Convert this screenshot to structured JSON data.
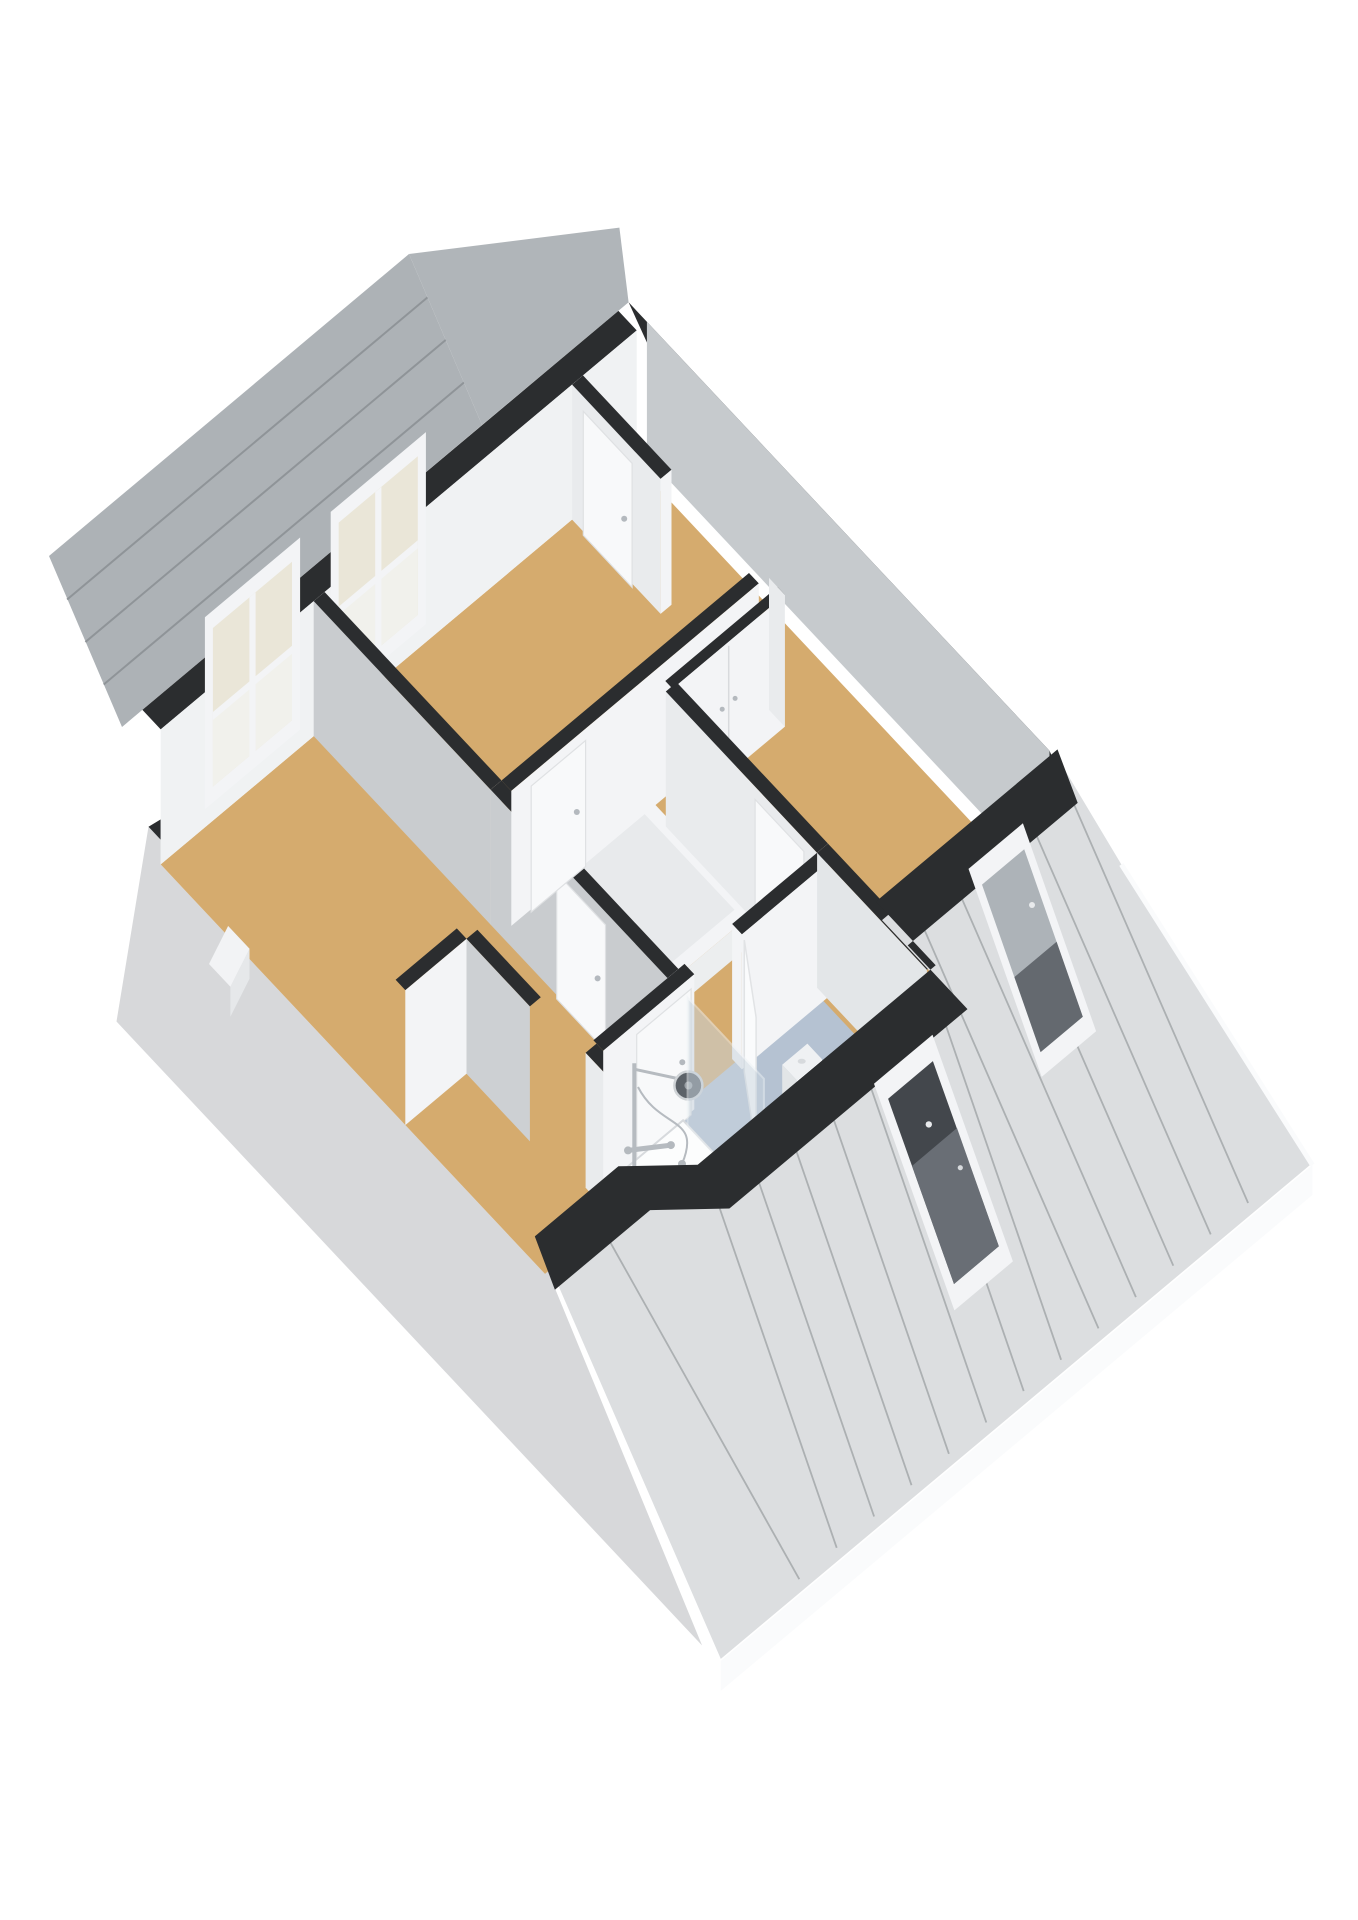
{
  "view": {
    "type": "3d-floorplan-isometric",
    "floor_label": "attic floor",
    "background": "#ffffff",
    "has_visible_text": false
  },
  "palette": {
    "bg": "#ffffff",
    "floor_wood": "#d5ab6e",
    "floor_bath": "#b5c2d2",
    "wall_top_dark": "#2b2d2f",
    "wall_white_light": "#f3f4f6",
    "wall_white_mid": "#e9ebed",
    "wall_gray_shadow": "#c9cccf",
    "ceiling_gray": "#c6cacd",
    "roof_light": "#dcdee0",
    "roof_line": "#a4a8ab",
    "roof_nw": "#adb2b6",
    "roof_nw_line": "#8f9498",
    "stucco": "#d7d8da",
    "fascia": "#fafbfc",
    "door_white": "#f8f9fa",
    "door_edge": "#dfe1e3",
    "handle_gray": "#b4b9be",
    "frame_white": "#f3f4f6",
    "window_glass_cream": "#eae6d8",
    "window_glass_lower": "#f1f1ec",
    "roofwindow_glass_dark": "#43474c",
    "roofwindow_glass_gray": "#adb3b8",
    "roofwindow_glass_gray_dark": "#575c61",
    "vanity_gray": "#6c7278",
    "chrome": "#b6bbc0",
    "shower_head_dark": "#5c6268",
    "fixture_white": "#fcfdfd",
    "fixture_edge": "#d7dadd",
    "screen_glass": "#cbd6e0"
  },
  "scene": {
    "rooms": [
      {
        "id": "bedroom-left",
        "floor": "wood"
      },
      {
        "id": "bedroom-top",
        "floor": "wood"
      },
      {
        "id": "landing",
        "floor": "wood"
      },
      {
        "id": "bedroom-right",
        "floor": "wood"
      },
      {
        "id": "storage-room",
        "floor": "wood"
      },
      {
        "id": "bathroom",
        "floor": "bath"
      }
    ],
    "windows": {
      "facade_windows": 2,
      "roof_windows": 2
    },
    "doors": {
      "hinged": 6,
      "closet_double": 1,
      "open_leaf": 1
    },
    "fixtures": [
      "stair-opening",
      "shower-set",
      "shower-screen",
      "toilet",
      "washbasin",
      "chimney"
    ]
  }
}
